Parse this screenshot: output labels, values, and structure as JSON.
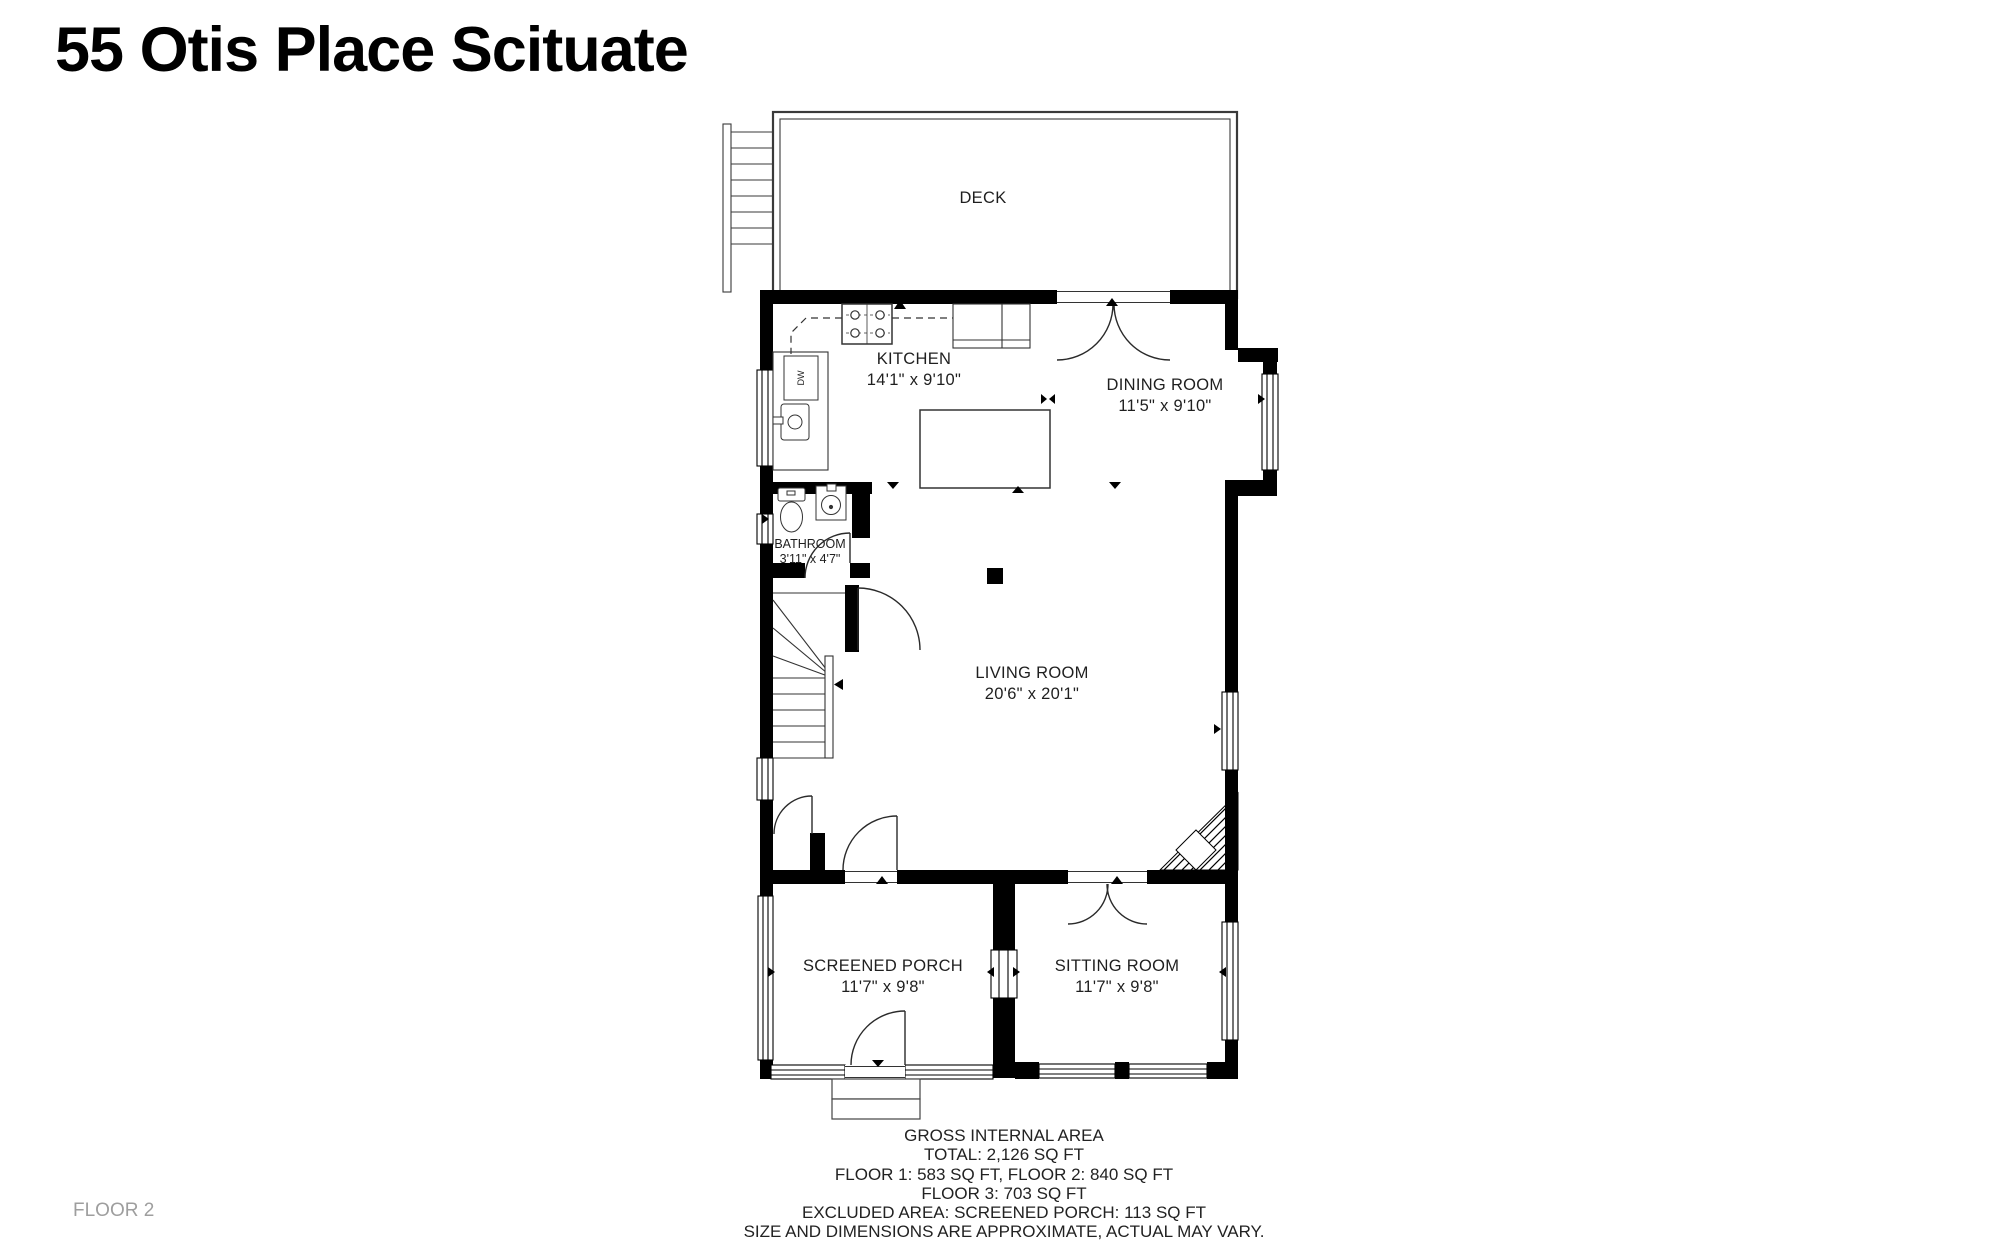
{
  "title": "55 Otis Place Scituate",
  "floor_label": "FLOOR 2",
  "rooms": {
    "deck": {
      "name": "DECK"
    },
    "kitchen": {
      "name": "KITCHEN",
      "dims": "14'1\" x 9'10\""
    },
    "dining": {
      "name": "DINING ROOM",
      "dims": "11'5\" x 9'10\""
    },
    "bathroom": {
      "name": "BATHROOM",
      "dims": "3'11\" x 4'7\""
    },
    "living": {
      "name": "LIVING ROOM",
      "dims": "20'6\" x 20'1\""
    },
    "porch": {
      "name": "SCREENED PORCH",
      "dims": "11'7\" x 9'8\""
    },
    "sitting": {
      "name": "SITTING ROOM",
      "dims": "11'7\" x 9'8\""
    }
  },
  "fixtures": {
    "dishwasher": "DW"
  },
  "summary": {
    "line1": "GROSS INTERNAL AREA",
    "line2": "TOTAL: 2,126 SQ FT",
    "line3": "FLOOR 1: 583 SQ FT, FLOOR 2: 840 SQ FT",
    "line4": "FLOOR 3: 703 SQ FT",
    "line5": "EXCLUDED AREA: SCREENED PORCH: 113 SQ FT",
    "line6": "SIZE AND DIMENSIONS ARE APPROXIMATE, ACTUAL MAY VARY."
  },
  "colors": {
    "wall": "#000000",
    "line": "#222222",
    "text": "#1a1a1a",
    "floor_label": "#9e9e9e",
    "background": "#ffffff"
  }
}
